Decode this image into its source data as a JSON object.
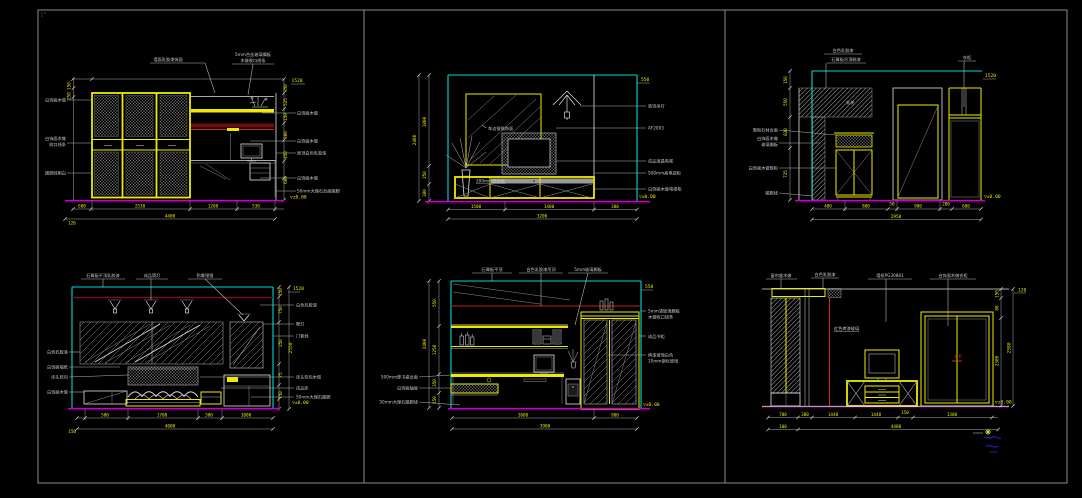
{
  "colors": {
    "background": "#000000",
    "sheet_border": "#8c8c8c",
    "line_white": "#e0e0e0",
    "accent_yellow": "#ecec00",
    "accent_cyan": "#00d8d8",
    "floor_magenta": "#cc00cc",
    "accent_red": "#e02020",
    "dim_text": "#e6e600",
    "note_text": "#c9c9c9"
  },
  "panels": {
    "p1": {
      "top_note_a": "墙面乳胶漆饰面",
      "top_note_b1": "5mm合金玻璃搁板",
      "top_note_b2": "木做收口线条",
      "left_notes": [
        "白饰面木做",
        "白饰面木做",
        "收口线条",
        "踢脚线刷白"
      ],
      "right_notes": [
        "白饰面木做",
        "白饰面木做",
        "原顶白色乳胶漆",
        "白饰面木做",
        "50mm大理石台面踢脚"
      ],
      "left_dims": [
        "150",
        "250"
      ],
      "right_dims": [
        "350",
        "525",
        "150",
        "300",
        "450",
        "600"
      ],
      "corner_dim": "1520",
      "level": "▽±0.00",
      "dims": [
        "600",
        "2530",
        "1200",
        "530"
      ],
      "total": "4400",
      "offset": "120"
    },
    "p2": {
      "glass_note": "车边银镜饰面",
      "cabinet_note": "200mm厚台面",
      "right_notes": [
        "装饰吊灯",
        "AF2003",
        "成品液晶电视",
        "500mm高电视柜",
        "白饰面木做电视柜"
      ],
      "left_total": "2400",
      "left_dims": [
        "1800",
        "250",
        "380"
      ],
      "corner_dim": "550",
      "level": "▽±0.00",
      "dims": [
        "1500",
        "1400",
        "300"
      ],
      "total": "3200"
    },
    "p3": {
      "top_note_a1": "白色乳胶漆",
      "top_note_a2": "石膏板吊顶刷漆",
      "top_note_b": "衣柜",
      "hatch_label": "玄关",
      "left_notes": [
        "鞋柜石材台面",
        "白饰面木做",
        "玻璃搁板",
        "白饰面木做鞋柜",
        "踢脚线"
      ],
      "left_dims": [
        "150",
        "550",
        "820",
        "725"
      ],
      "corner_dim": "1520",
      "level": "▽±0.00",
      "dims": [
        "400",
        "800",
        "50",
        "900",
        "200",
        "600"
      ],
      "total": "2950"
    },
    "p4": {
      "top_notes": [
        "石膏板平顶乳胶漆",
        "成品筒灯",
        "防雾银镜"
      ],
      "left_notes": [
        "白色乳胶漆",
        "白饰面墙纸",
        "床头软包",
        "白饰面木做"
      ],
      "right_notes": [
        "白色乳胶漆",
        "壁灯",
        "门套线",
        "床头软包木做",
        "成品床",
        "50mm大理石踢脚"
      ],
      "right_dims": [
        "150",
        "750",
        "250",
        "75",
        "750"
      ],
      "side_total": "2550",
      "corner_dim": "1520",
      "level": "▽±0.00",
      "dims": [
        "500",
        "1700",
        "300",
        "1000"
      ],
      "total": "4000",
      "offset": "150"
    },
    "p5": {
      "top_notes": [
        "石膏板平顶",
        "白色乳胶漆吊顶",
        "5mm玻璃搁板"
      ],
      "left_notes": [
        "500mm厚书桌台面",
        "白饰面抽屉",
        "50mm大理石踢脚线"
      ],
      "right_note_a1": "5mm清玻璃搁板",
      "right_note_a2": "木做收口线条",
      "right_note_b": "成品书柜",
      "right_note_c1": "烤漆玻璃白色",
      "right_note_c2": "10mm钢化玻璃",
      "left_total": "2400",
      "left_dims": [
        "550",
        "1250",
        "350",
        "150"
      ],
      "corner_dim": "550",
      "level": "▽±0.00",
      "dims": [
        "3000",
        "900"
      ],
      "total": "3900"
    },
    "p6": {
      "top_notes": [
        "窗帘盒木做",
        "白色乳胶漆",
        "墙纸PG30881",
        "白饰面木做衣柜"
      ],
      "mid_note": "红色烤漆玻璃",
      "handle_note": "拉手",
      "right_dims": [
        "150",
        "80"
      ],
      "side_dim": "2380",
      "side_total": "2580",
      "corner_dim": "120",
      "level": "▽±0.00",
      "dims": [
        "700",
        "300",
        "1440",
        "1440",
        "150",
        "1300"
      ],
      "sub_total": "100",
      "total": "4480"
    }
  }
}
